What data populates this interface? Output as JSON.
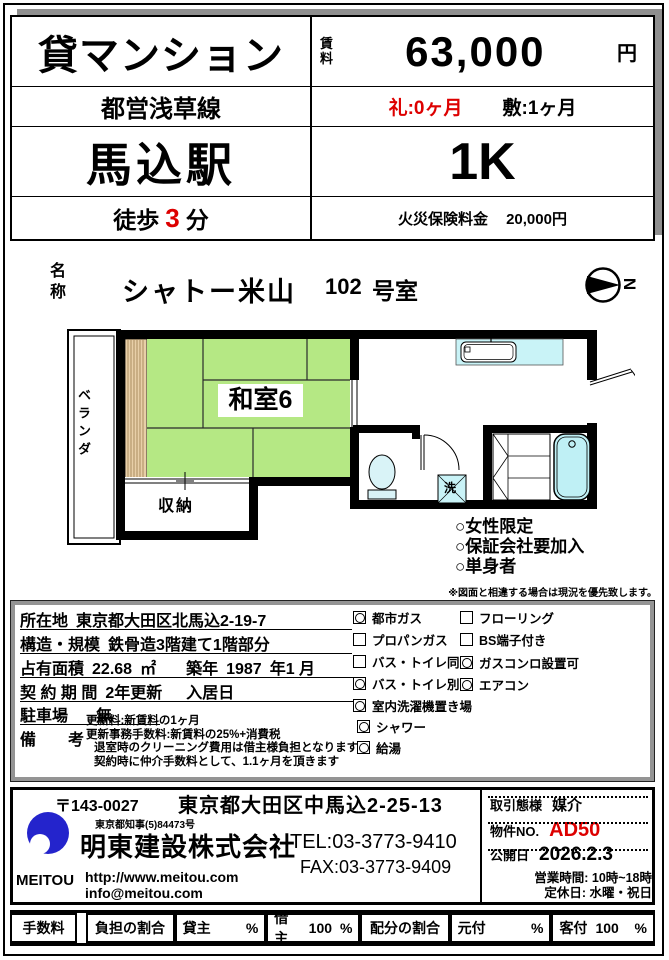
{
  "header": {
    "title": "貸マンション",
    "rent_label": "賃料",
    "rent_value": "63,000",
    "rent_unit": "円",
    "train_line": "都営浅草線",
    "key_money": "礼:0ヶ月",
    "deposit": "敷:1ヶ月",
    "station": "馬込駅",
    "floor_plan_type": "1K",
    "walk_prefix": "徒歩",
    "walk_minutes": "3",
    "walk_suffix": "分",
    "fire_insurance_label": "火災保険料金",
    "fire_insurance_value": "20,000円"
  },
  "name_section": {
    "label": "名称",
    "building_name": "シャトー米山",
    "room_no": "102",
    "room_suffix": "号室",
    "compass_letter": "N"
  },
  "floorplan": {
    "balcony_label": "ベランダ",
    "room_label": "和室6",
    "closet_label": "収納",
    "washer_label": "洗",
    "note1": "○女性限定",
    "note2": "○保証会社要加入",
    "note3": "○単身者",
    "disclaimer": "※図面と相違する場合は現況を優先致します。"
  },
  "details": {
    "address_label": "所在地",
    "address": "東京都大田区北馬込2-19-7",
    "structure_label": "構造・規模",
    "structure": "鉄骨造3階建て1階部分",
    "area_label": "占有面積",
    "area": "22.68",
    "area_unit": "㎡",
    "built_label": "築年",
    "built_year": "1987",
    "built_month": "年1 月",
    "contract_label": "契 約 期 間",
    "contract": "2年更新",
    "movein_label": "入居日",
    "movein": "",
    "parking_label": "駐車場",
    "parking": "無",
    "remarks_label": "備　　考",
    "remarks": [
      "更新料:新賃料の1ヶ月",
      "更新事務手数料:新賃料の25%+消費税",
      "退室時のクリーニング費用は借主様負担となります",
      "契約時に仲介手数料として、1.1ヶ月を頂きます"
    ],
    "features_col1": [
      {
        "label": "都市ガス",
        "checked": true
      },
      {
        "label": "プロパンガス",
        "checked": false
      },
      {
        "label": "バス・トイレ同",
        "checked": false
      },
      {
        "label": "バス・トイレ別",
        "checked": true
      },
      {
        "label": "室内洗濯機置き場",
        "checked": true
      },
      {
        "label": "シャワー",
        "checked": true
      },
      {
        "label": "給湯",
        "checked": true
      }
    ],
    "features_col2": [
      {
        "label": "フローリング",
        "checked": false
      },
      {
        "label": "BS端子付き",
        "checked": false
      },
      {
        "label": "ガスコンロ設置可",
        "checked": true
      },
      {
        "label": "エアコン",
        "checked": true
      }
    ]
  },
  "company": {
    "postal": "〒143-0027",
    "address": "東京都大田区中馬込2-25-13",
    "license": "東京都知事(5)84473号",
    "name": "明東建設株式会社",
    "tel": "TEL:03-3773-9410",
    "fax": "FAX:03-3773-9409",
    "logo_text": "MEITOU",
    "website": "http://www.meitou.com",
    "email": "info@meitou.com",
    "transaction_label": "取引態様",
    "transaction": "媒介",
    "property_no_label": "物件NO.",
    "property_no": "AD50",
    "publish_label": "公開日",
    "publish_date": "2026.2.3",
    "hours": "営業時間: 10時~18時",
    "closed": "定休日: 水曜・祝日"
  },
  "commission": {
    "fee_label": "手数料",
    "burden_label": "負担の割合",
    "landlord_label": "貸主",
    "landlord_value": "",
    "tenant_label": "借主",
    "tenant_value": "100",
    "percent": "%",
    "allocation_label": "配分の割合",
    "listing_label": "元付",
    "listing_value": "",
    "client_label": "客付",
    "client_value": "100"
  },
  "colors": {
    "accent_red": "#dd0000",
    "tatami_green": "#b5e884",
    "water_blue": "#c9f3f7",
    "wood_tan": "#e8cfa8",
    "logo_blue": "#2424cc"
  }
}
